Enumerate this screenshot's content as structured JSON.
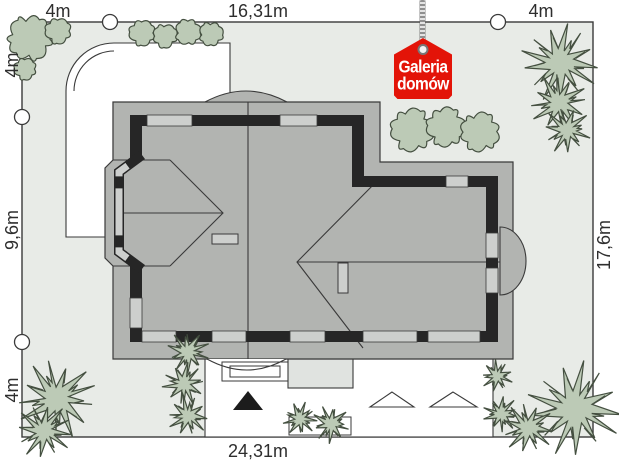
{
  "badge": {
    "line1": "Galeria",
    "line2": "domów"
  },
  "dimensions": {
    "top_left": "4m",
    "top_center": "16,31m",
    "top_right": "4m",
    "left_top": "4m",
    "left_middle": "9,6m",
    "left_bottom": "4m",
    "right_side": "17,6m",
    "bottom": "24,31m"
  },
  "colors": {
    "badge_red": "#e31408",
    "plot_fill": "#e8ebe7",
    "paving_white": "#ffffff",
    "terrace_fill": "#e0e3e0",
    "roof_fill": "#b2b4b1",
    "window_fill": "#cdcfcd",
    "wall_black": "#262626",
    "line": "#3a3a3a",
    "tree_fill": "#bccab6",
    "tree_stroke": "#444f40"
  },
  "landscape": {
    "bushes": [
      [
        30,
        38,
        24
      ],
      [
        58,
        31,
        14
      ],
      [
        25,
        69,
        12
      ],
      [
        142,
        33,
        14
      ],
      [
        165,
        36,
        13
      ],
      [
        188,
        32,
        14
      ],
      [
        211,
        34,
        13
      ],
      [
        412,
        130,
        23
      ],
      [
        446,
        127,
        21
      ],
      [
        480,
        132,
        21
      ]
    ],
    "conifers": [
      [
        560,
        63,
        36
      ],
      [
        559,
        103,
        27
      ],
      [
        567,
        130,
        22
      ],
      [
        57,
        399,
        37
      ],
      [
        44,
        431,
        26
      ],
      [
        188,
        352,
        20
      ],
      [
        184,
        384,
        20
      ],
      [
        188,
        416,
        19
      ],
      [
        300,
        419,
        16
      ],
      [
        331,
        424,
        18
      ],
      [
        497,
        376,
        15
      ],
      [
        501,
        414,
        17
      ],
      [
        575,
        409,
        44
      ],
      [
        528,
        428,
        24
      ]
    ]
  }
}
